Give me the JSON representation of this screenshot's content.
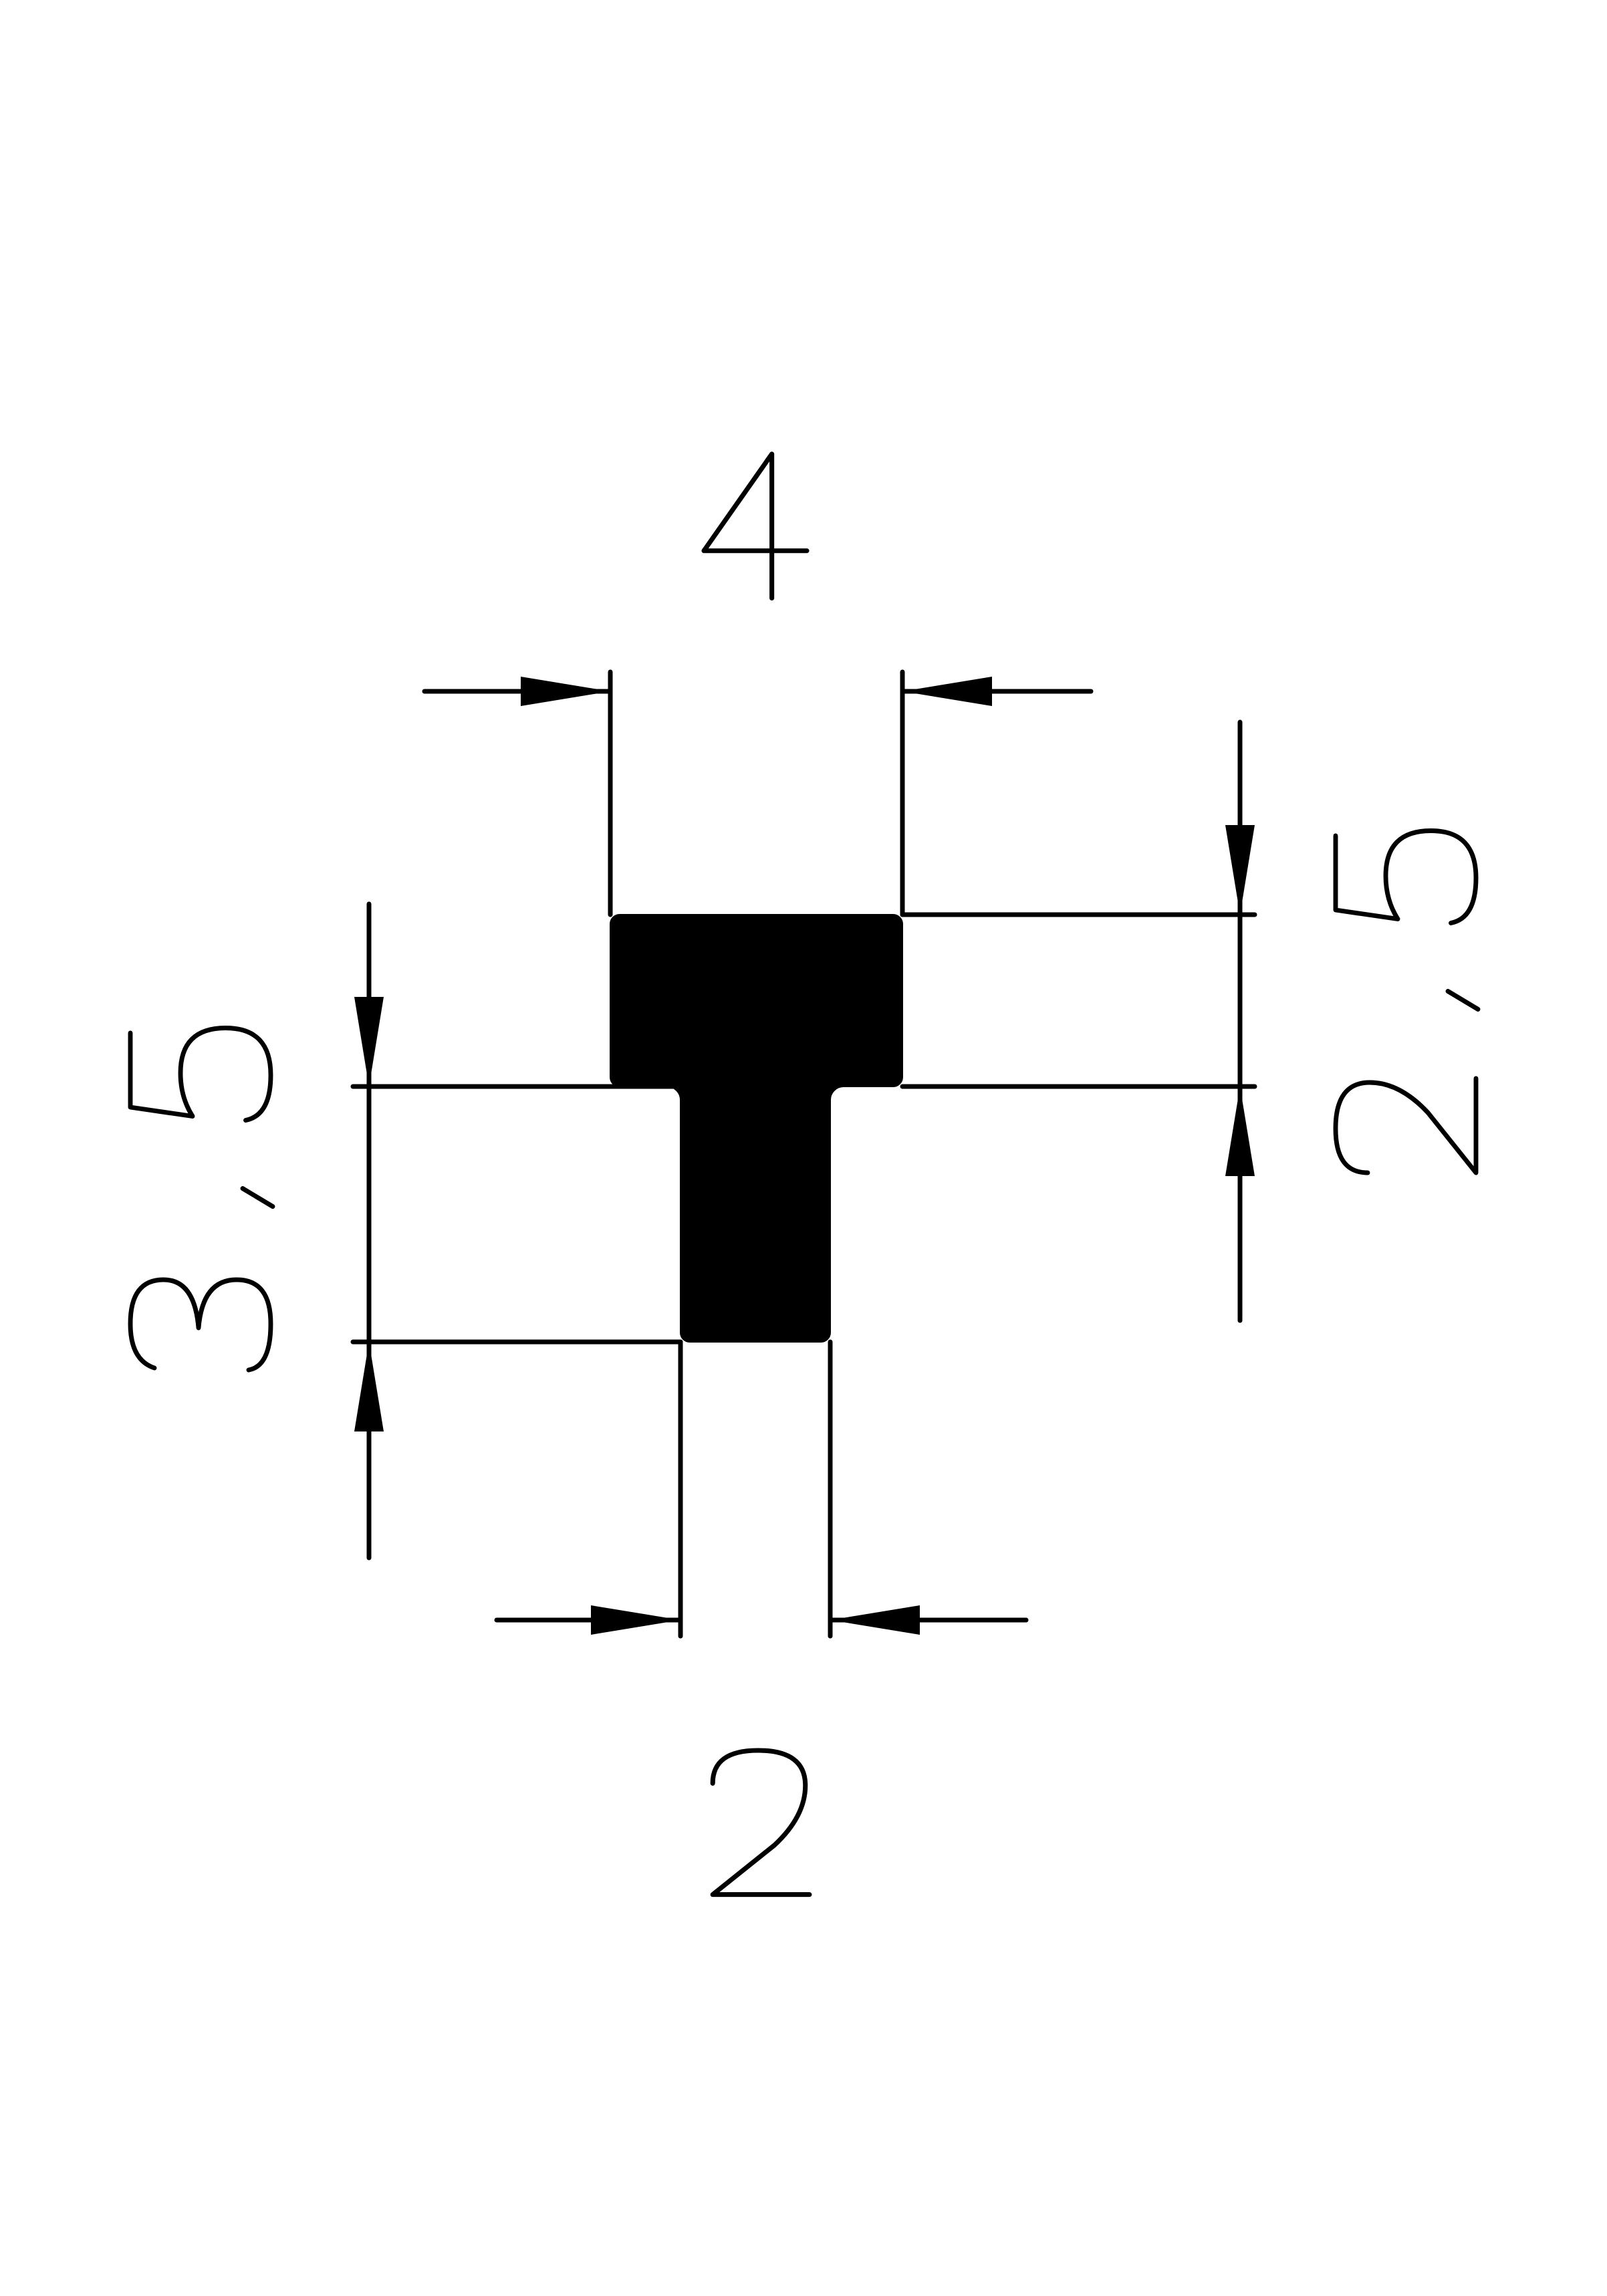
{
  "colors": {
    "background": "#ffffff",
    "ink": "#000000"
  },
  "drawing": {
    "kind": "profile-cross-section",
    "shape": "T-profile"
  },
  "dimensions": {
    "top_width": {
      "value": "4",
      "orientation": "horizontal",
      "position": "top"
    },
    "right_height": {
      "value": "2.5",
      "orientation": "vertical",
      "position": "right"
    },
    "left_height": {
      "value": "3.5",
      "orientation": "vertical",
      "position": "left"
    },
    "bottom_width": {
      "value": "2",
      "orientation": "horizontal",
      "position": "bottom"
    }
  }
}
